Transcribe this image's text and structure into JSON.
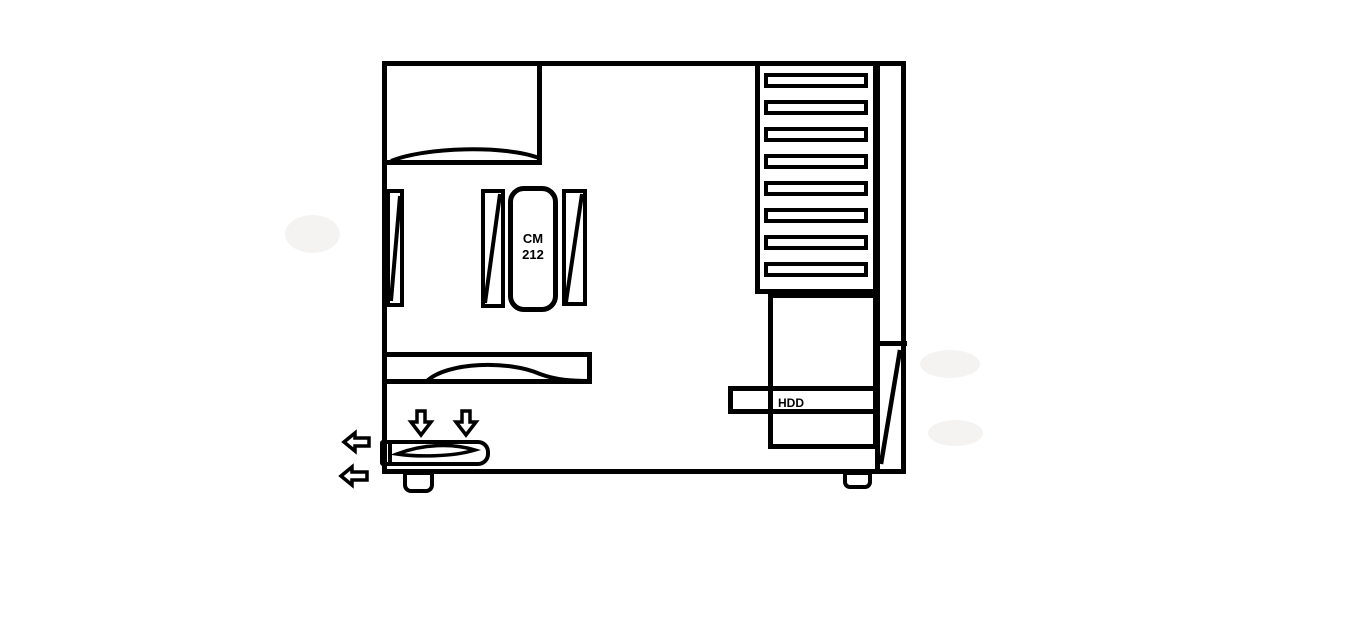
{
  "title": "Hand-drawn PC case side-view airflow sketch",
  "colors": {
    "ink": "#000000",
    "background": "#ffffff"
  },
  "labels": {
    "cooler_line1": "CM",
    "cooler_line2": "212",
    "hdd": "HDD"
  },
  "drive_bays": {
    "slat_count": 8
  },
  "airflow": {
    "down_arrow_count": 2,
    "left_arrow_count": 2,
    "down_arrow_icon": "outline-down-arrow",
    "left_arrow_icon": "outline-left-arrow"
  }
}
